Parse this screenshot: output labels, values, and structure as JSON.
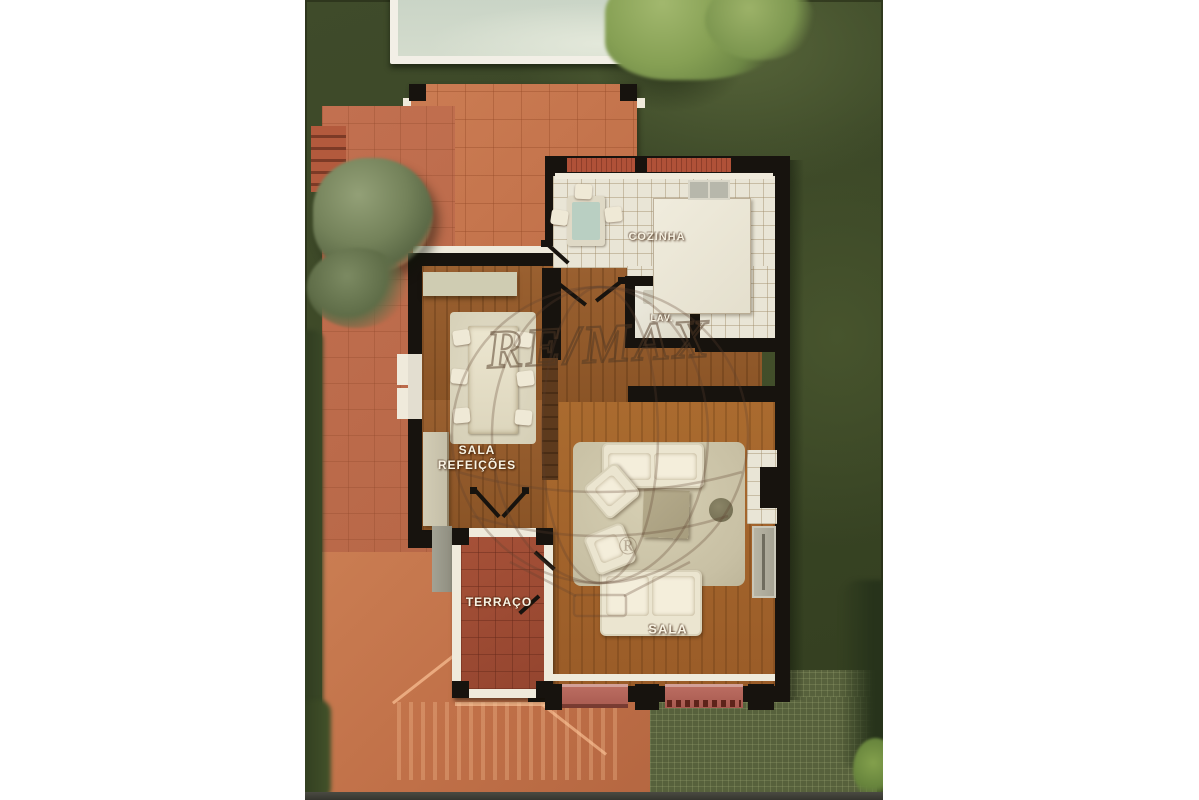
{
  "document": {
    "type": "3d-floor-plan-top-down-render",
    "description": "Aerial rendered floor plan of a house ground floor with garden, pool, terrace and roof of lower volume"
  },
  "watermark": {
    "brand": "RE/MAX",
    "registered": "®"
  },
  "rooms": {
    "cozinha": {
      "label": "COZINHA"
    },
    "lav": {
      "label": "LAV."
    },
    "sala_refeicoes": {
      "line1": "SALA",
      "line2": "REFEIÇÕES"
    },
    "terraco": {
      "label": "TERRAÇO"
    },
    "sala": {
      "label": "SALA"
    }
  },
  "outdoor_features": [
    "swimming-pool",
    "garden-grass",
    "terracotta-patio",
    "garden-steps",
    "trees",
    "hedge",
    "lower-roof",
    "pergola-deck"
  ],
  "colors": {
    "grass_dark": "#3a4626",
    "grass_light": "#566439",
    "patio_orange": "#c87950",
    "terrace_red": "#a14e35",
    "roof_red": "#c4744c",
    "wood_floor": "#9a6030",
    "wood_floor_light": "#aa6b2f",
    "kitchen_tile": "#e9e5d6",
    "wall_black": "#17130e",
    "trim_white": "#efeadb",
    "window_sill_red": "#b4645a",
    "pergola_green": "#57613c",
    "pool_water": "#ccd7c8",
    "label_text": "#f8f3e3"
  }
}
